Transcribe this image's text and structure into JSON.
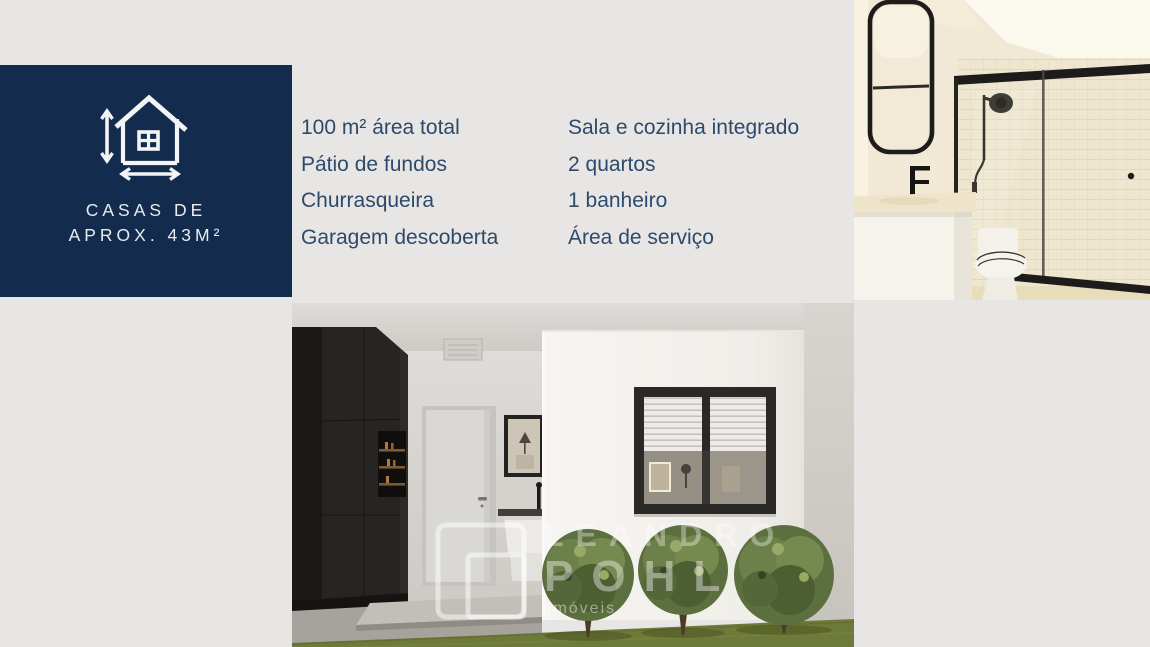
{
  "page": {
    "background": "#e7e6e4"
  },
  "badge": {
    "line1": "CASAS DE",
    "line2": "APROX. 43M²",
    "background": "#132b4d",
    "text_color": "#e9edf1",
    "icon": "house-measurements-icon"
  },
  "features": {
    "text_color": "#2d4a6b",
    "col1": [
      "100 m² área total",
      "Pátio de fundos",
      "Churrasqueira",
      "Garagem descoberta"
    ],
    "col2": [
      "Sala e cozinha integrado",
      "2 quartos",
      "1 banheiro",
      "Área de serviço"
    ]
  },
  "photos": {
    "bathroom_label": "bathroom-interior-render",
    "house_label": "house-exterior-render"
  },
  "watermark": {
    "line1": "LEANDRO",
    "line2": "POHL",
    "line3": "Imóveis"
  }
}
